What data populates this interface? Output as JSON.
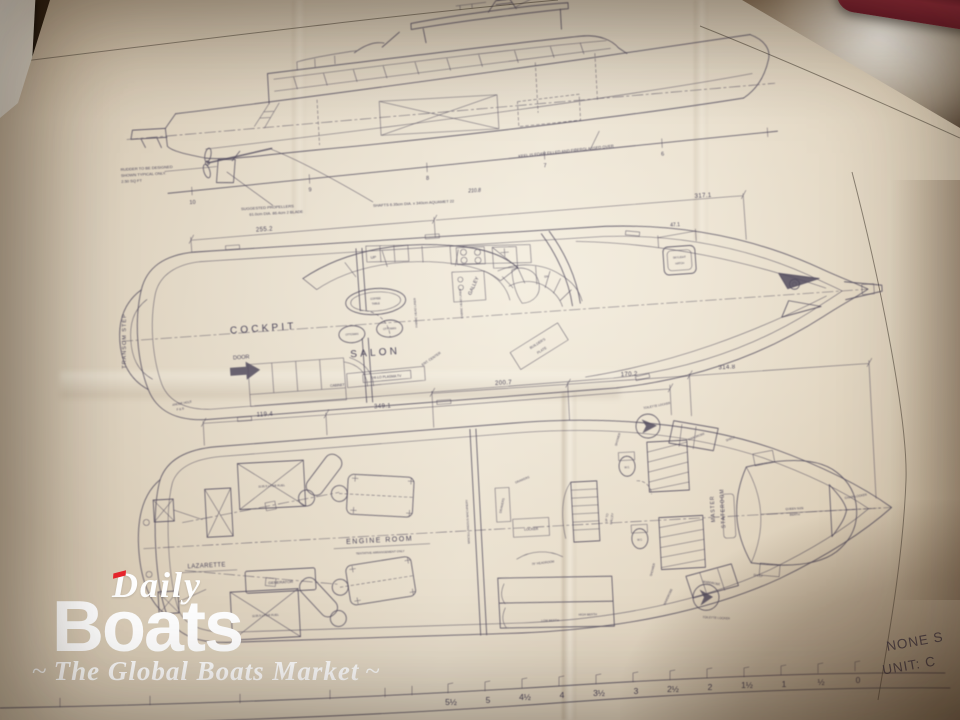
{
  "watermark": {
    "daily": "Daily",
    "boats": "Boats",
    "tagline": "The Global Boats Market",
    "flourish": "~",
    "red": "#e8262d"
  },
  "sheet": {
    "scale_note": "NONE S",
    "unit_note": "UNIT: C"
  },
  "profile": {
    "rudder_note": [
      "RUDDER TO BE DESIGNED",
      "SHOWN TYPICAL ONLY.",
      "2.50 SQ FT"
    ],
    "prop_note": [
      "SUGGESTED PROPELLERS",
      "61.0cm DIA. 86.4cm  2 BLADE"
    ],
    "shaft_note": "SHAFTS  6.35cm  DIA. x 340cm  AQUAMET 22",
    "keel_note": "KEEL IS FOAM FILLED AND FIBERGLASSED OVER",
    "waterline_dim": "210.8",
    "stations": [
      "10",
      "9",
      "8",
      "7",
      "6"
    ]
  },
  "main_deck": {
    "dim_cockpit": "255.2",
    "dim_salon": "317.1",
    "dim_hatch": "47.1",
    "transom_step": "TRANSOM STEP",
    "cockpit": "COCKPIT",
    "door": "DOOR",
    "salon": "SALON",
    "galley": "GALLEY",
    "coffee_table": [
      "COFFEE",
      "TABLE"
    ],
    "ottoman": "OTTOMAN",
    "tv": "HI-LO PLASMA TV",
    "cabinet": "CABINET",
    "ent_center": "ENT. CENTER",
    "builders_plate": [
      "BUILDER'S",
      "PLATE"
    ],
    "skylight": [
      "SKYLIGHT",
      "HATCH"
    ],
    "head_liner": "FABRIC HEAD LINER",
    "anode": [
      "ANODE HOLE",
      "F & B"
    ],
    "up": "UP",
    "dn": "DN"
  },
  "lower_deck": {
    "dims": [
      "119.4",
      "349.1",
      "200.7",
      "170.2",
      "314.8"
    ],
    "lazarette": "LAZARETTE",
    "engine_room": "ENGINE ROOM",
    "tentative": "TENTATIVE ARRANGEMENT ONLY",
    "generator": "GENERATOR",
    "fuel": "1135.5 LITER FUEL",
    "machinery": "MISCELLANEOUS MACHINERY",
    "master": [
      "MASTER",
      "STATEROOM"
    ],
    "queen": [
      "QUEEN SIZE",
      "BERTH"
    ],
    "chain_locker": "CHAIN LOCKER",
    "wc": "W.C.",
    "shower": "SHOWER",
    "wardrobe": "WARDROBE",
    "toilette_locker": "TOILETTE LOCKER",
    "shelf": "SHELF",
    "locker": "LOCKER",
    "drawers": "DRAWERS",
    "low_berth": "LOW BERTH",
    "high_berth": "HIGH BERTH",
    "headroom": "76\" HEADROOM",
    "up_to_galley": [
      "UP TO",
      "GALLEY"
    ]
  },
  "ruler": {
    "labels": [
      "5½",
      "5",
      "4½",
      "4",
      "3½",
      "3",
      "2½",
      "2",
      "1½",
      "1",
      "½",
      "0"
    ]
  }
}
